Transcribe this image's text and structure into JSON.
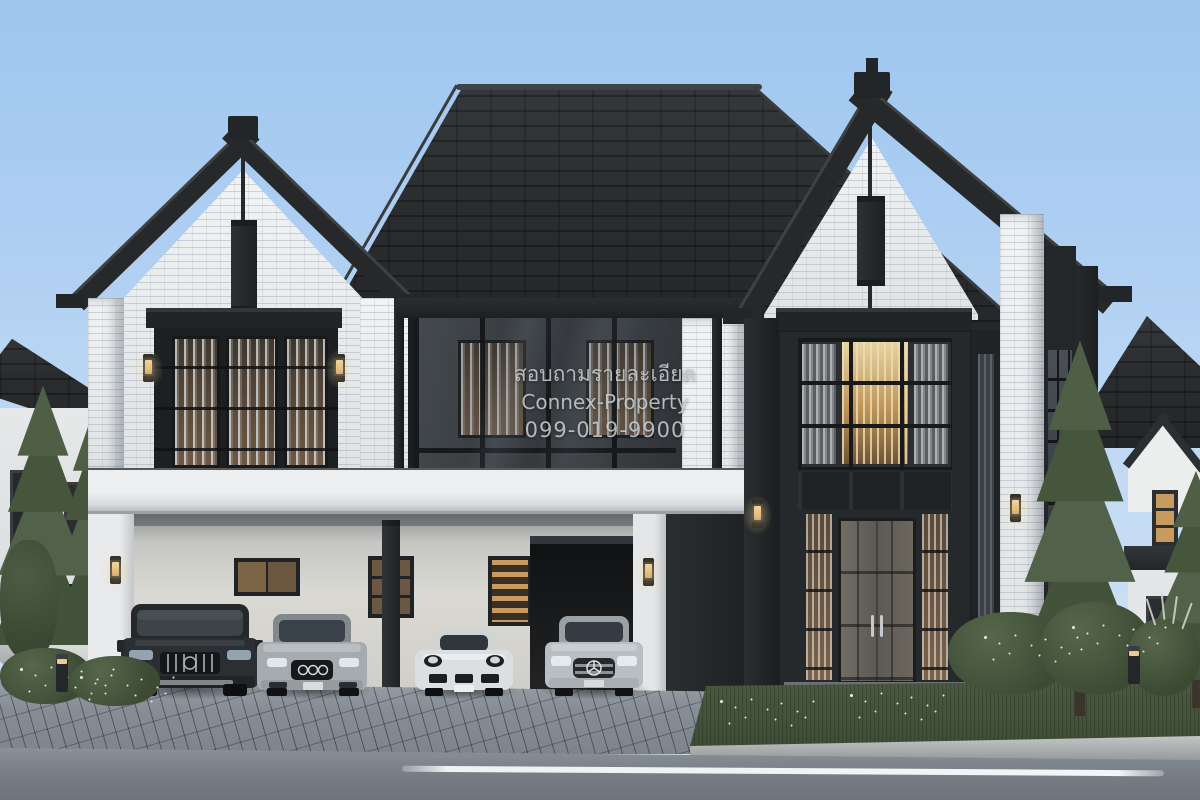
{
  "watermark": {
    "line1": "สอบถามรายละเอียด",
    "line2": "Connex-Property",
    "line3": "099-019-9900"
  },
  "scene": {
    "type": "exterior architectural rendering at dusk",
    "subject": "modern two-story black-and-white brick house with carport, four parked cars, pine trees and street",
    "colors": {
      "sky_top": "#9ec6ef",
      "sky_horizon": "#d6e5f6",
      "roof_shingles": "#2a2c2e",
      "white_brick": "#eff1f2",
      "dark_trim": "#232628",
      "carport_fascia": "#e6e8ea",
      "warm_window_light": "#c9a36c",
      "lawn_green": "#46543c",
      "road_asphalt": "#757c83",
      "paver_gray": "#868d95"
    }
  }
}
